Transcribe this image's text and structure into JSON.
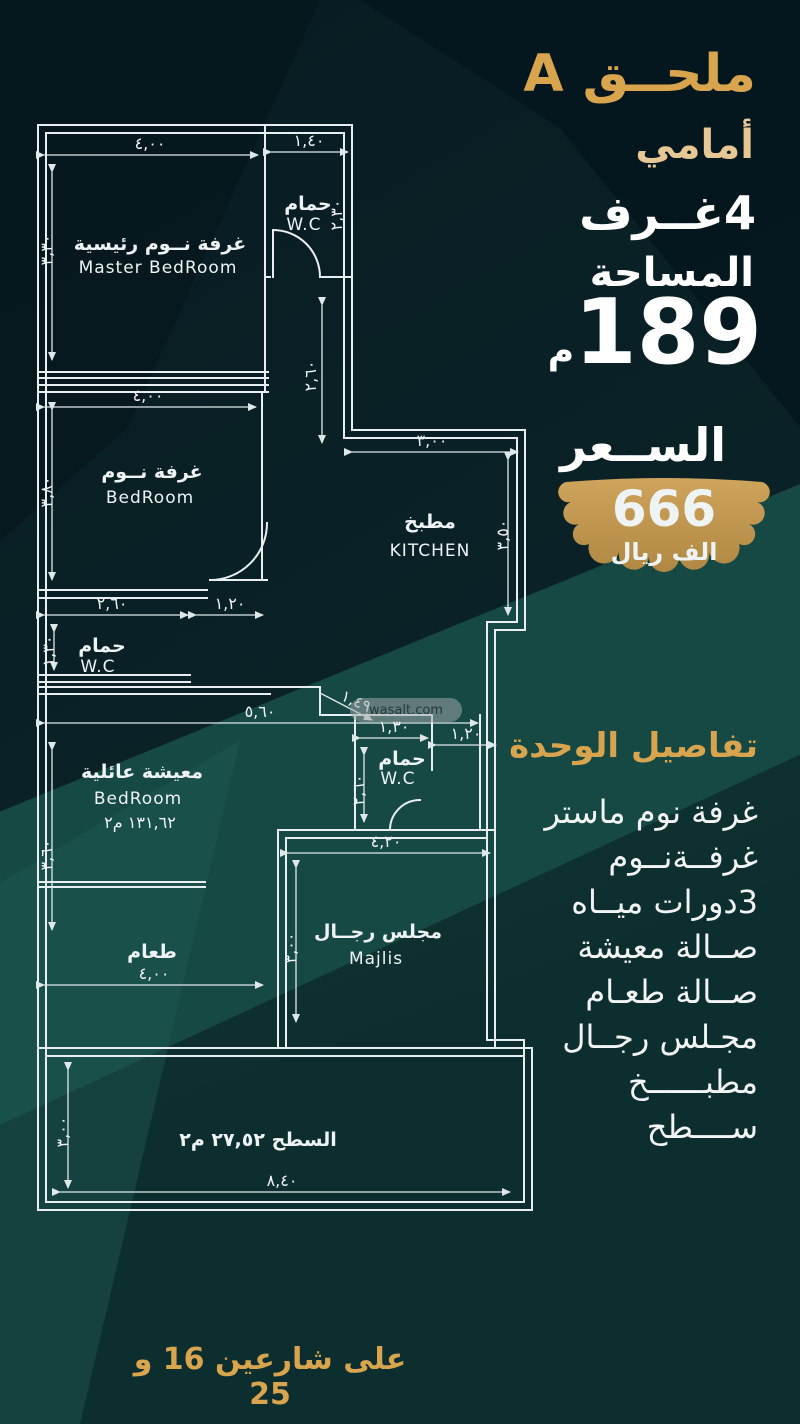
{
  "panel": {
    "annex_title": "ملحــق A",
    "annex_subtitle": "أمامي",
    "rooms_count": "4غــرف",
    "area_label": "المساحة",
    "area_value": "189",
    "area_unit": "م",
    "price_label": "الســعر",
    "price_value": "666",
    "price_unit": "الف ريال",
    "details_title": "تفاصيل الوحدة",
    "details": [
      {
        "label": "غرفة نوم ماستر"
      },
      {
        "label": "غرفــةنــوم"
      },
      {
        "label": "3دورات ميــاه"
      },
      {
        "label": "صــالة معيشة"
      },
      {
        "label": "صــالة طعـام"
      },
      {
        "label": "مجـلس رجــال"
      },
      {
        "label": "مطبــــــخ"
      },
      {
        "label": "ســــطح"
      }
    ],
    "footer": "على شارعين 16 و 25"
  },
  "plan": {
    "watermark": "wasalt.com",
    "master": {
      "name_ar": "غرفة نــوم رئيسية",
      "name_en": "Master BedRoom",
      "w": "٤,٠٠",
      "h": "٣,٣٠"
    },
    "wc_top": {
      "name_ar": "حمام",
      "name_en": "W.C",
      "w": "١,٤٠",
      "h": "٢,٣٠"
    },
    "corridor": {
      "h": "٢,٦٠"
    },
    "bedroom": {
      "name_ar": "غرفة نــوم",
      "name_en": "BedRoom",
      "w": "٤,٠٠",
      "h": "٣,٨٠"
    },
    "kitchen": {
      "name_ar": "مطبخ",
      "name_en": "KITCHEN",
      "w": "٣,٠٠",
      "h": "٣,٥٠"
    },
    "wc_left": {
      "name_ar": "حمام",
      "name_en": "W.C",
      "w1": "٢,٦٠",
      "w2": "١,٢٠",
      "h": "١,٣٠"
    },
    "hall": {
      "w": "٥,٦٠",
      "leader": "١,٤٩"
    },
    "living": {
      "name_ar": "معيشة عائلية",
      "name_en": "BedRoom",
      "area": "١٣١,٦٢ م٢",
      "h": "٣,٦٠"
    },
    "wc_mid": {
      "name_ar": "حمام",
      "name_en": "W.C",
      "w": "١,٣٠",
      "w2": "١,٢٠",
      "h": "٢,٦٠"
    },
    "dining": {
      "name_ar": "طعام",
      "w": "٤,٠٠"
    },
    "majlis": {
      "name_ar": "مجلس رجــال",
      "name_en": "Majlis",
      "w": "٤,٢٠",
      "h": "٣,٠٠"
    },
    "roof": {
      "label": "السطح  ٢٧,٥٢ م٢",
      "w": "٨,٤٠",
      "h": "٣,٠٠"
    }
  }
}
